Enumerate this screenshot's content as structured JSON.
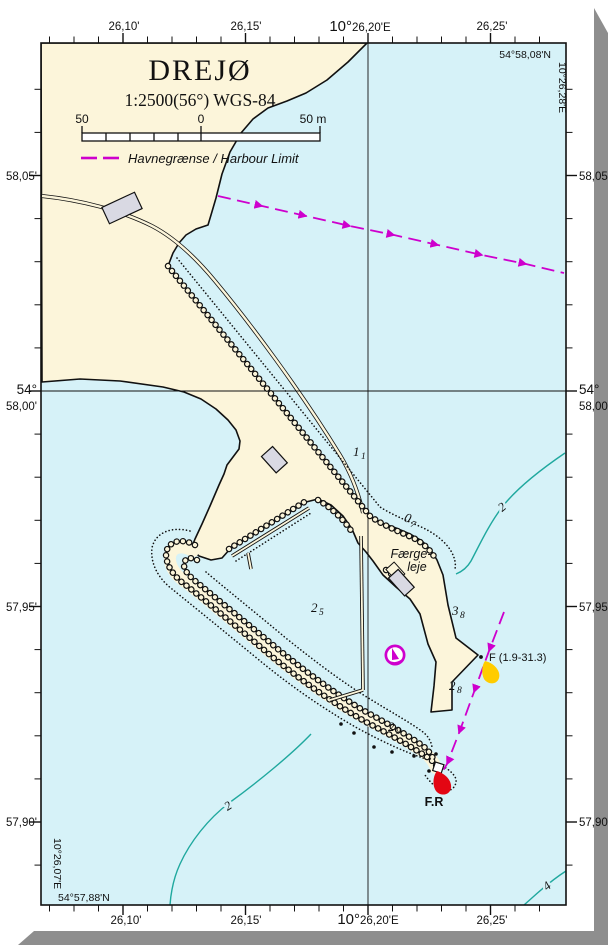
{
  "page": {
    "title": "DREJØ",
    "scale_text": "1:2500(56°) WGS-84",
    "scalebar": {
      "left": "50",
      "zero": "0",
      "right": "50 m"
    },
    "legend_label": "Havnegrænse / Harbour Limit",
    "axes": {
      "top": [
        {
          "label": "26,10'"
        },
        {
          "label": "26,15'"
        },
        {
          "label": "26,25'"
        }
      ],
      "top_meridian": {
        "deg": "10°",
        "min": "26,20'E"
      },
      "bottom": [
        {
          "label": "26,10'"
        },
        {
          "label": "26,15'"
        },
        {
          "label": "26,25'"
        }
      ],
      "bottom_meridian": {
        "deg": "10°",
        "min": "26,20'E"
      },
      "left": {
        "l1": "58,05'",
        "deg": "54°",
        "l2": "58,00'",
        "l3": "57,95'",
        "l4": "57,90'"
      },
      "right": {
        "l1": "58,05'",
        "deg": "54°",
        "l2": "58,00'",
        "l3": "57,95'",
        "l4": "57,90'"
      }
    },
    "corners": {
      "top_right_lat": "54°58,08'N",
      "right_lon": "10°26,28'E",
      "left_lon": "10°26,07'E",
      "bottom_left_lat": "54°57,88'N"
    },
    "map_labels": {
      "ferry_line1": "Færge-",
      "ferry_line2": "leje",
      "light_fr": "F.R",
      "light_f": "F (1.9-31.3)"
    },
    "soundings": {
      "s1": {
        "main": "1",
        "sub": "1"
      },
      "s2": {
        "main": "0",
        "sub": "7"
      },
      "s3": {
        "main": "2",
        "sub": "5"
      },
      "s4": {
        "main": "3",
        "sub": "8"
      },
      "s5": {
        "main": "2",
        "sub": "8"
      },
      "s6": {
        "main": "2",
        "sub": "9"
      }
    },
    "contours": {
      "c2a": "2",
      "c2b": "2",
      "c4": "4"
    },
    "colors": {
      "water": "#d6f2f8",
      "land": "#fcf5da",
      "magenta": "#ce00cd",
      "contour": "#1fa89e",
      "red": "#e30613",
      "yellow": "#ffcc00",
      "building": "#d9d9e3",
      "shadow": "#8e8e8e",
      "ink": "#111111"
    }
  }
}
